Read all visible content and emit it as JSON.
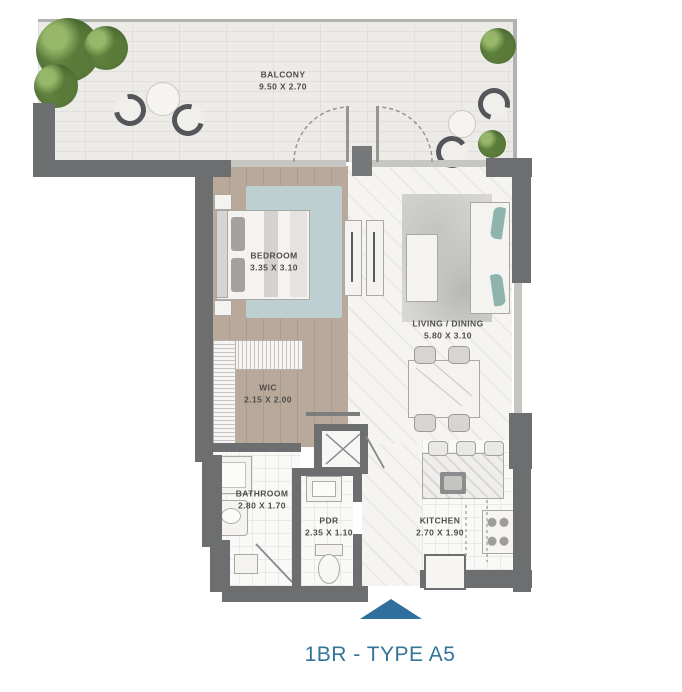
{
  "title": "1BR - TYPE A5",
  "rooms": [
    {
      "id": "balcony",
      "name": "BALCONY",
      "dims": "9.50 X 2.70"
    },
    {
      "id": "bedroom",
      "name": "BEDROOM",
      "dims": "3.35 X 3.10"
    },
    {
      "id": "living",
      "name": "LIVING / DINING",
      "dims": "5.80 X 3.10"
    },
    {
      "id": "wic",
      "name": "WIC",
      "dims": "2.15 X 2.00"
    },
    {
      "id": "bathroom",
      "name": "BATHROOM",
      "dims": "2.80 X 1.70"
    },
    {
      "id": "pdr",
      "name": "PDR",
      "dims": "2.35 X 1.10"
    },
    {
      "id": "kitchen",
      "name": "KITCHEN",
      "dims": "2.70 X 1.90"
    }
  ],
  "colors": {
    "wall": "#6d6e70",
    "title_blue": "#337499",
    "entry_arrow_blue": "#2e6f9e",
    "rug_teal": "#becfd1",
    "sofa_teal": "#8fb3ad",
    "tree_green": "#5c8040",
    "label_text": "#504e4a"
  }
}
